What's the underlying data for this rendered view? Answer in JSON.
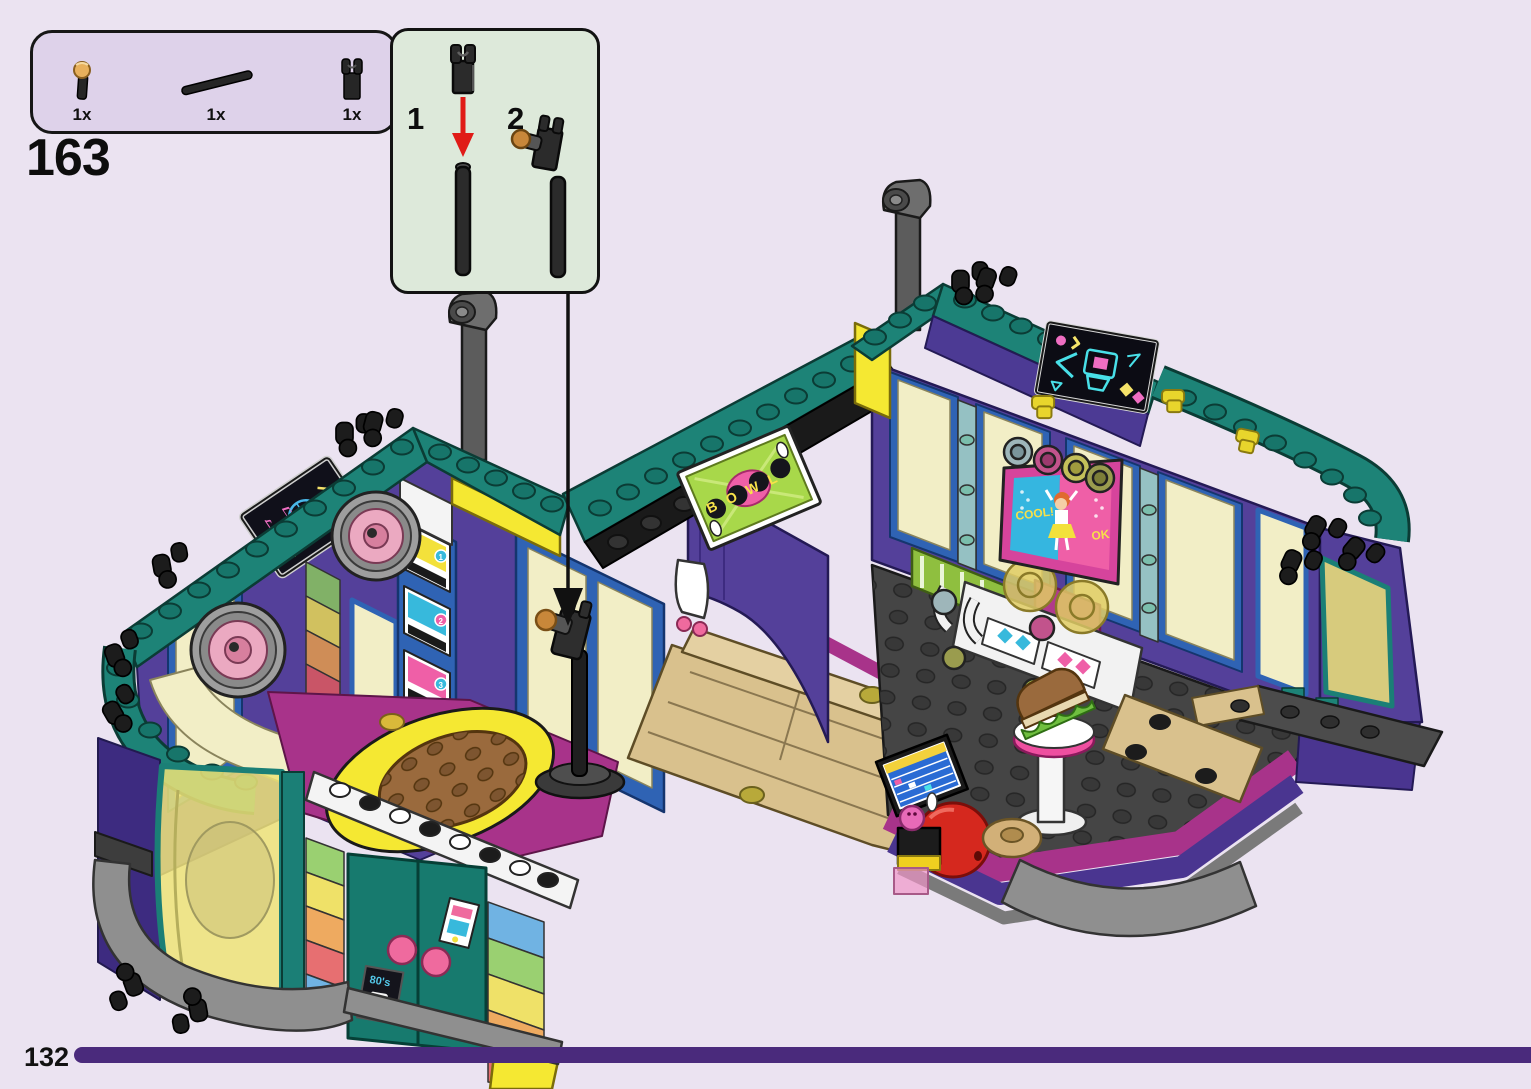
{
  "page": {
    "step_number": "163",
    "page_number": "132"
  },
  "parts_callout": {
    "items": [
      {
        "name": "microphone",
        "qty": "1x"
      },
      {
        "name": "bar-4l",
        "qty": "1x"
      },
      {
        "name": "bar-holder-clip",
        "qty": "1x"
      }
    ]
  },
  "subassembly": {
    "steps": [
      {
        "label": "1"
      },
      {
        "label": "2"
      }
    ]
  },
  "model": {
    "name": "roller-disco-arcade-build",
    "signs": {
      "bowl_sign": "BOWL",
      "screen_cool": "COOL!",
      "screen_ok": "OK",
      "door_poster": "80's",
      "music_notes": "♪ ♫",
      "poster_numbers": [
        "1",
        "2",
        "3"
      ]
    },
    "colors": {
      "background": "#ebe3f1",
      "footer_bar": "#4a2a7c",
      "callout_bg": "#ded2ea",
      "subassembly_bg": "#dde9da",
      "roof_teal": "#1d8377",
      "door_teal": "#177a6e",
      "wall_purple": "#54409a",
      "frame_blue": "#2f63b4",
      "window_cream": "#f2eec6",
      "accent_magenta": "#a8338a",
      "accent_yellow": "#f5e832",
      "wood_tan": "#d9c18d",
      "ball_red": "#d5281e",
      "arrow_red": "#e01b17"
    }
  }
}
